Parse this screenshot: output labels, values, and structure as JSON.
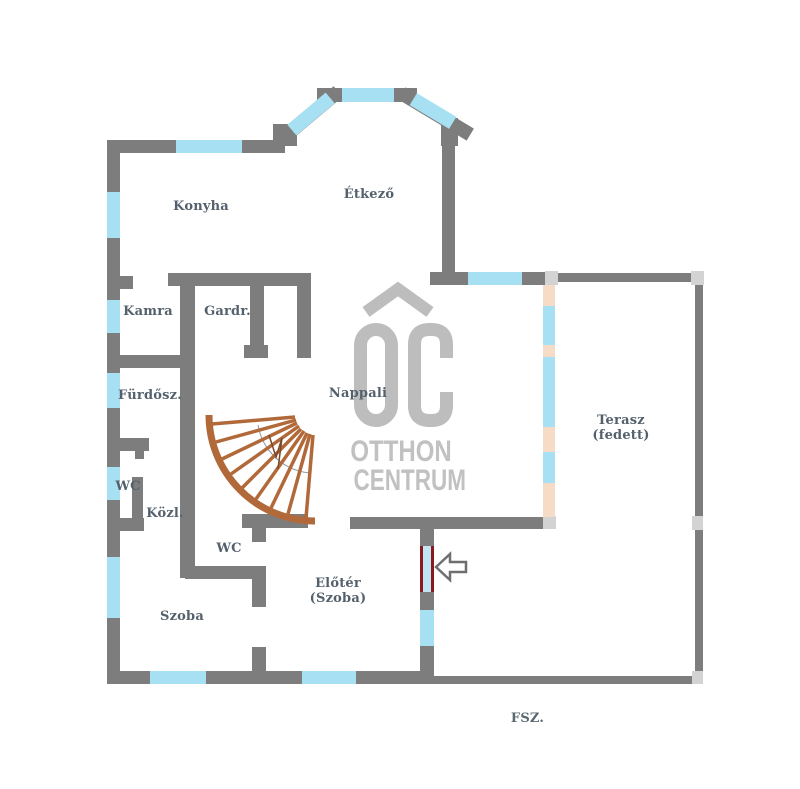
{
  "rooms": {
    "konyha": "Konyha",
    "etkezo": "Étkező",
    "kamra": "Kamra",
    "gardrob": "Gardr.",
    "nappali": "Nappali",
    "furdoszoba": "Fürdősz.",
    "wc_upper": "WC",
    "kozlekedo": "Közl.",
    "wc_lower": "WC",
    "szoba": "Szoba",
    "eloter_line1": "Előtér",
    "eloter_line2": "(Szoba)",
    "terasz_line1": "Terasz",
    "terasz_line2": "(fedett)"
  },
  "floor_label": "FSZ.",
  "watermark": {
    "brand_initials": "OC",
    "line1": "OTTHON",
    "line2": "CENTRUM"
  },
  "legend_colors": {
    "wall": "#7d7d7d",
    "window": "#a7e0f2",
    "door_opening": "#f6dcc6",
    "entry_door_frame": "#8c1922",
    "entry_door_glass": "#bfe6f2",
    "stairs": "#b2693a",
    "terrace_post": "#d3d3d3",
    "label_text": "#54616d",
    "watermark": "#bdbdbd"
  }
}
